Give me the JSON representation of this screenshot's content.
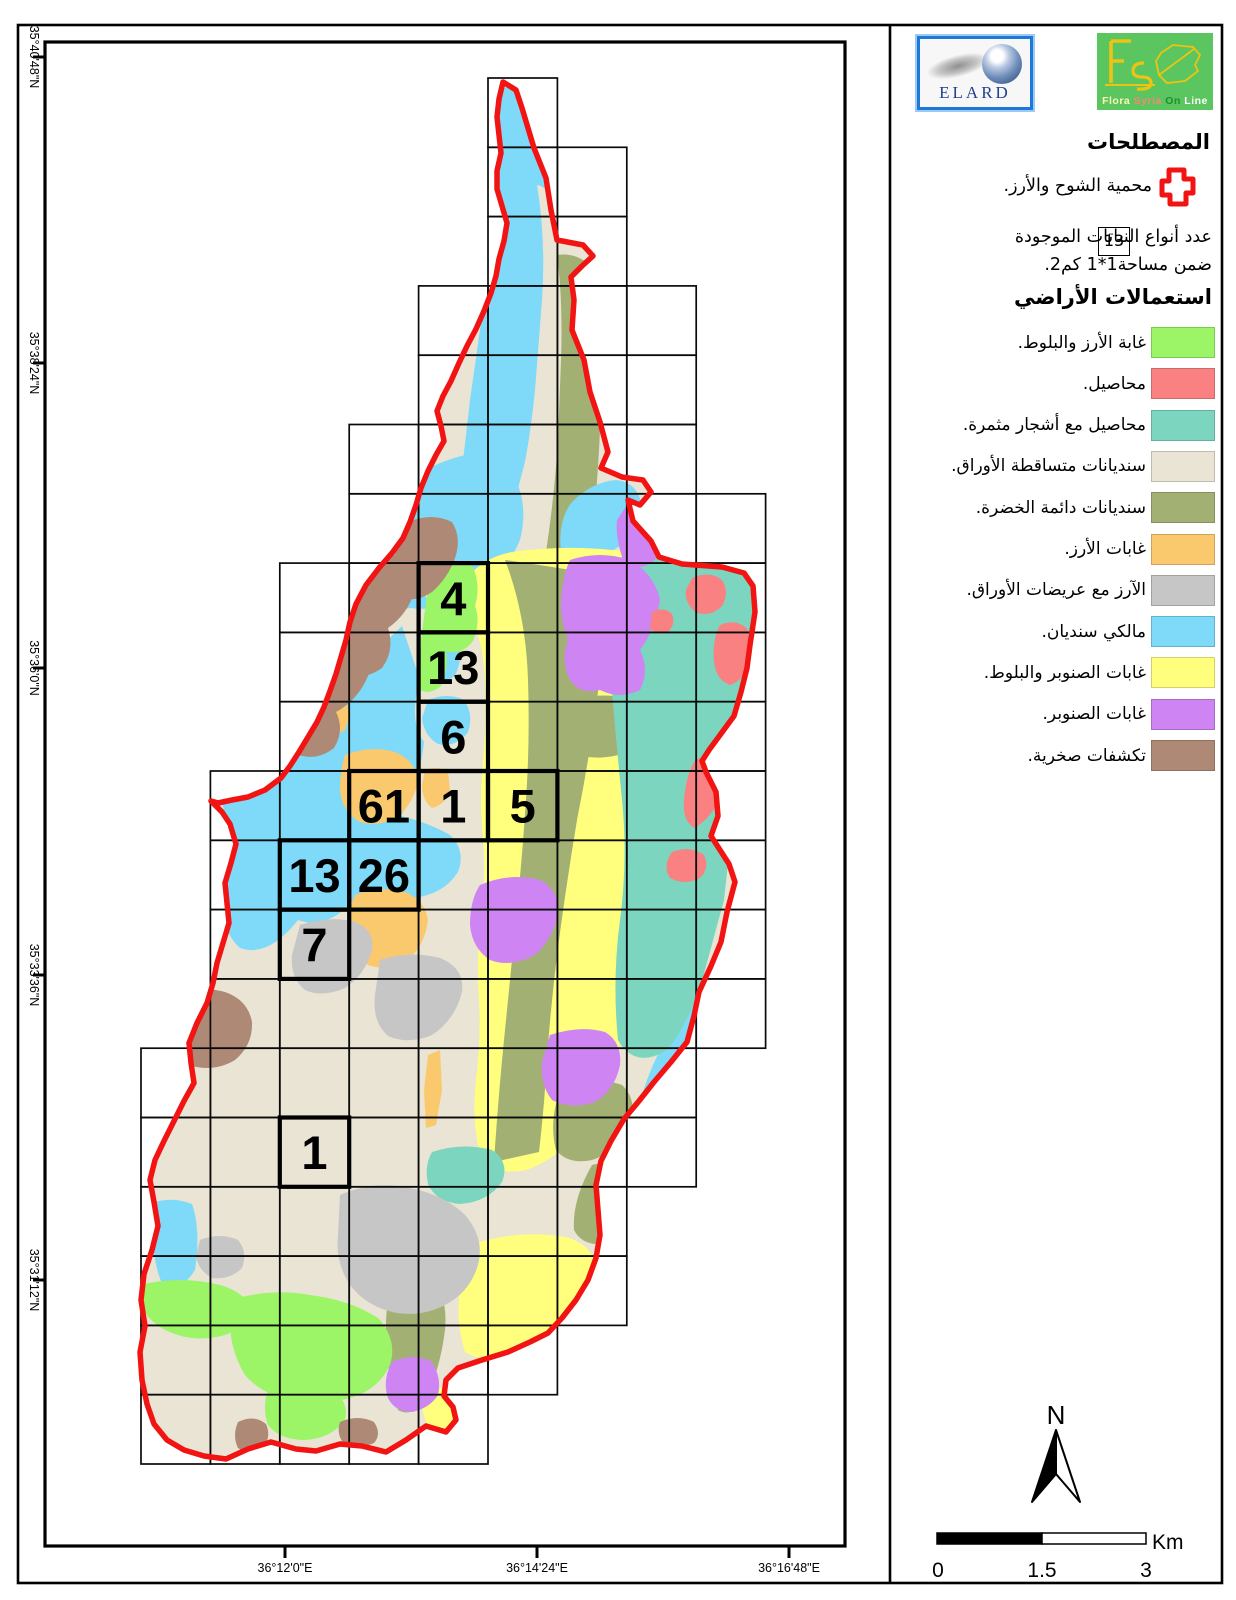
{
  "logos": {
    "elard": {
      "label": "ELARD"
    },
    "flora": {
      "words": [
        {
          "text": "Flora",
          "color": "#fdf7b4"
        },
        {
          "text": "Syria",
          "color": "#f2897a"
        },
        {
          "text": "On",
          "color": "#1d8f2c"
        },
        {
          "text": "Line",
          "color": "#ffffff"
        }
      ]
    }
  },
  "legend": {
    "title": "المصطلحات",
    "reserve": {
      "label": "محمية الشوح والأرز."
    },
    "species_count": {
      "box": "13",
      "line1": "عدد أنواع النباتات الموجودة",
      "line2": "ضمن مساحة1*1 كم2."
    },
    "landuse_title": "استعمالات الأراضي",
    "items": [
      {
        "label": "غابة الأرز والبلوط.",
        "color": "#9cf467"
      },
      {
        "label": "محاصيل.",
        "color": "#f98181"
      },
      {
        "label": "محاصيل مع أشجار مثمرة.",
        "color": "#7cd6bf"
      },
      {
        "label": "سنديانات متساقطة الأوراق.",
        "color": "#e9e4d3"
      },
      {
        "label": "سنديانات دائمة الخضرة.",
        "color": "#a2b173"
      },
      {
        "label": "غابات الأرز.",
        "color": "#fac96d"
      },
      {
        "label": "الآرز مع عريضات الأوراق.",
        "color": "#c6c6c6"
      },
      {
        "label": "مالكي سنديان.",
        "color": "#7edaf8"
      },
      {
        "label": "غابات الصنوبر والبلوط.",
        "color": "#ffff7d"
      },
      {
        "label": "غابات الصنوبر.",
        "color": "#ce84f2"
      },
      {
        "label": "تكشفات صخرية.",
        "color": "#ae8a76"
      }
    ]
  },
  "map": {
    "boundary_color": "#f21313",
    "numbered_cells": [
      {
        "value": "4",
        "col": 4,
        "row": 7
      },
      {
        "value": "13",
        "col": 4,
        "row": 8
      },
      {
        "value": "6",
        "col": 4,
        "row": 9
      },
      {
        "value": "61",
        "col": 3,
        "row": 10
      },
      {
        "value": "1",
        "col": 4,
        "row": 10
      },
      {
        "value": "5",
        "col": 5,
        "row": 10
      },
      {
        "value": "13",
        "col": 2,
        "row": 11
      },
      {
        "value": "26",
        "col": 3,
        "row": 11
      },
      {
        "value": "7",
        "col": 2,
        "row": 12
      },
      {
        "value": "1",
        "col": 2,
        "row": 15
      }
    ],
    "axes": {
      "left": [
        {
          "text": "35°40'48\"N",
          "y": 57
        },
        {
          "text": "35°38'24\"N",
          "y": 363
        },
        {
          "text": "35°36'0\"N",
          "y": 668
        },
        {
          "text": "35°33'36\"N",
          "y": 975
        },
        {
          "text": "35°31'12\"N",
          "y": 1280
        }
      ],
      "bottom": [
        {
          "text": "36°12'0\"E",
          "x": 285
        },
        {
          "text": "36°14'24\"E",
          "x": 537
        },
        {
          "text": "36°16'48\"E",
          "x": 789
        }
      ]
    }
  },
  "north": {
    "label": "N"
  },
  "scalebar": {
    "start": "0",
    "middle": "1.5",
    "end": "3",
    "unit": "Km"
  }
}
